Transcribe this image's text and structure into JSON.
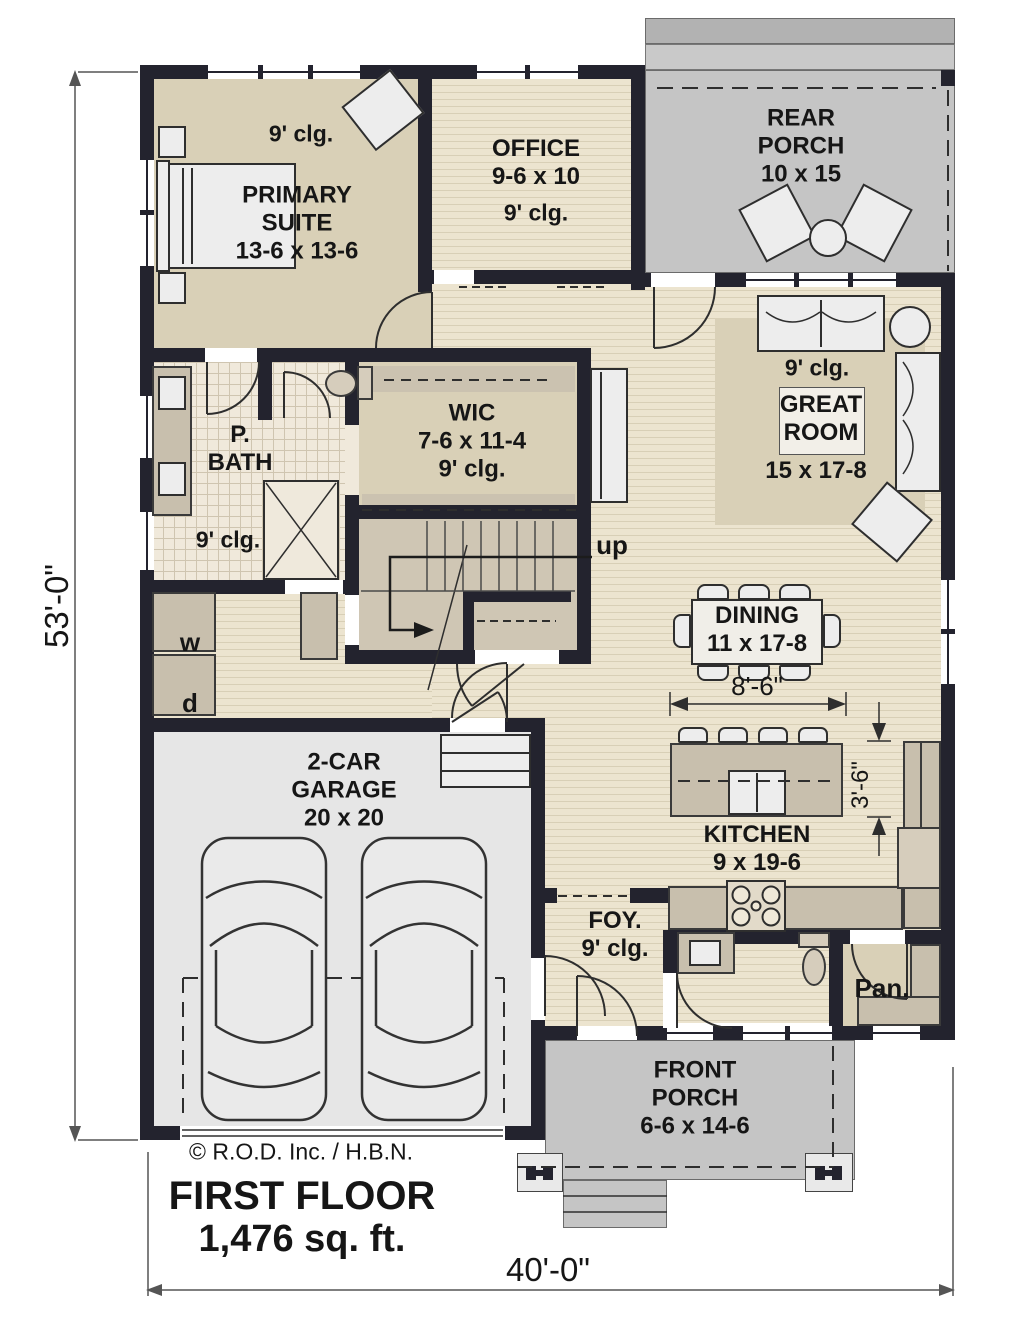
{
  "plan": {
    "title": "FIRST FLOOR",
    "area": "1,476 sq. ft.",
    "copyright": "© R.O.D. Inc. / H.B.N.",
    "overall_width": "40'-0\"",
    "overall_depth": "53'-0\""
  },
  "rooms": {
    "primary_suite": {
      "label": "PRIMARY\nSUITE\n13-6 x 13-6",
      "ceiling": "9' clg."
    },
    "office": {
      "label": "OFFICE\n9-6 x 10",
      "ceiling": "9' clg."
    },
    "rear_porch": {
      "label": "REAR\nPORCH\n10 x 15"
    },
    "great_room": {
      "label": "GREAT\nROOM",
      "dims": "15 x 17-8",
      "ceiling": "9' clg."
    },
    "wic": {
      "label": "WIC\n7-6 x 11-4\n9' clg."
    },
    "primary_bath": {
      "label": "P.\nBATH",
      "ceiling": "9' clg."
    },
    "dining": {
      "label": "DINING\n11 x 17-8",
      "clearance": "8'-6\""
    },
    "kitchen": {
      "label": "KITCHEN\n9 x 19-6",
      "island_clearance": "3'-6\""
    },
    "foyer": {
      "label": "FOY.\n9' clg."
    },
    "pantry": {
      "label": "Pan."
    },
    "garage": {
      "label": "2-CAR\nGARAGE\n20 x 20"
    },
    "laundry": {
      "washer": "w",
      "dryer": "d"
    },
    "front_porch": {
      "label": "FRONT\nPORCH\n6-6 x 14-6"
    },
    "stairs": {
      "label": "up"
    }
  },
  "colors": {
    "wall": "#23232e",
    "wood_floor": "#ece4cf",
    "wood_stripe": "#d8cfb6",
    "tan_floor": "#d9d0b7",
    "tile_floor": "#f0e9db",
    "porch_concrete": "#c5c5c5",
    "garage_floor": "#e6e6e6",
    "cabinet": "#c8bfad",
    "furniture": "#ededed"
  }
}
